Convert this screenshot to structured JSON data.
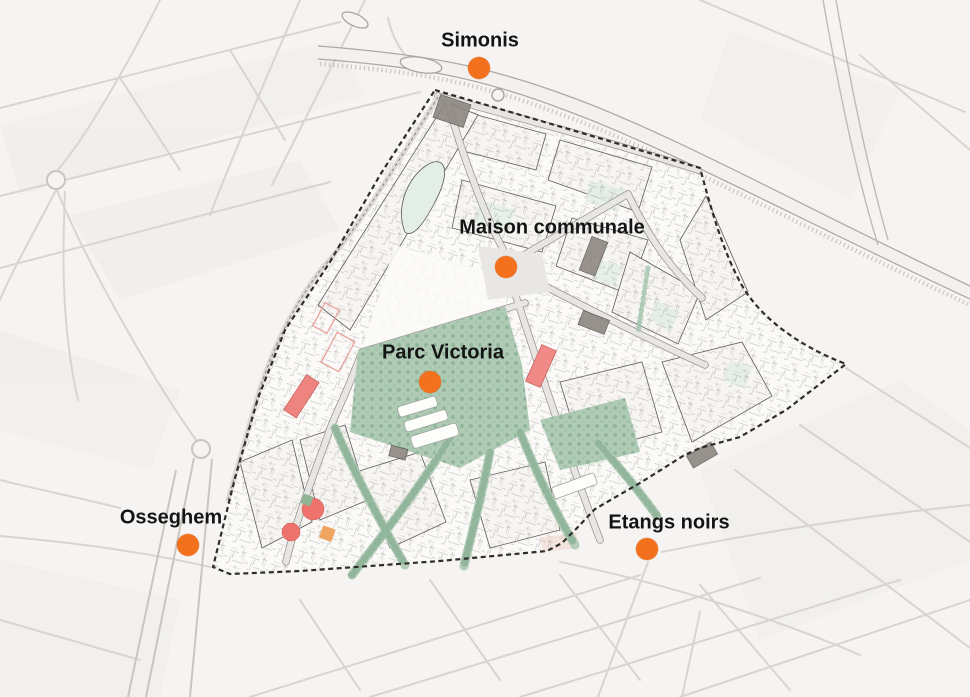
{
  "map": {
    "type": "urban-plan-map",
    "markers": [
      {
        "id": "simonis",
        "label": "Simonis",
        "x": 479,
        "y": 68,
        "label_x": 480,
        "label_y": 41
      },
      {
        "id": "maison-communale",
        "label": "Maison communale",
        "x": 506,
        "y": 267,
        "label_x": 552,
        "label_y": 228
      },
      {
        "id": "parc-victoria",
        "label": "Parc Victoria",
        "x": 430,
        "y": 382,
        "label_x": 443,
        "label_y": 353
      },
      {
        "id": "osseghem",
        "label": "Osseghem",
        "x": 188,
        "y": 545,
        "label_x": 171,
        "label_y": 518
      },
      {
        "id": "etangs-noirs",
        "label": "Etangs noirs",
        "x": 647,
        "y": 549,
        "label_x": 669,
        "label_y": 523
      }
    ],
    "marker_diameter_px": 22,
    "theme": {
      "marker_color": "#f3701d",
      "label_color": "#141414",
      "park_green": "#b0cbb5",
      "corridor_green": "#9fc2a9",
      "accent_red": "#ee8480",
      "accent_salmon": "#ed736c",
      "accent_orange_block": "#f0a45f",
      "grey_building": "#8d8681",
      "background": "#f6f4f2",
      "boundary": "#2f2d2b"
    }
  }
}
